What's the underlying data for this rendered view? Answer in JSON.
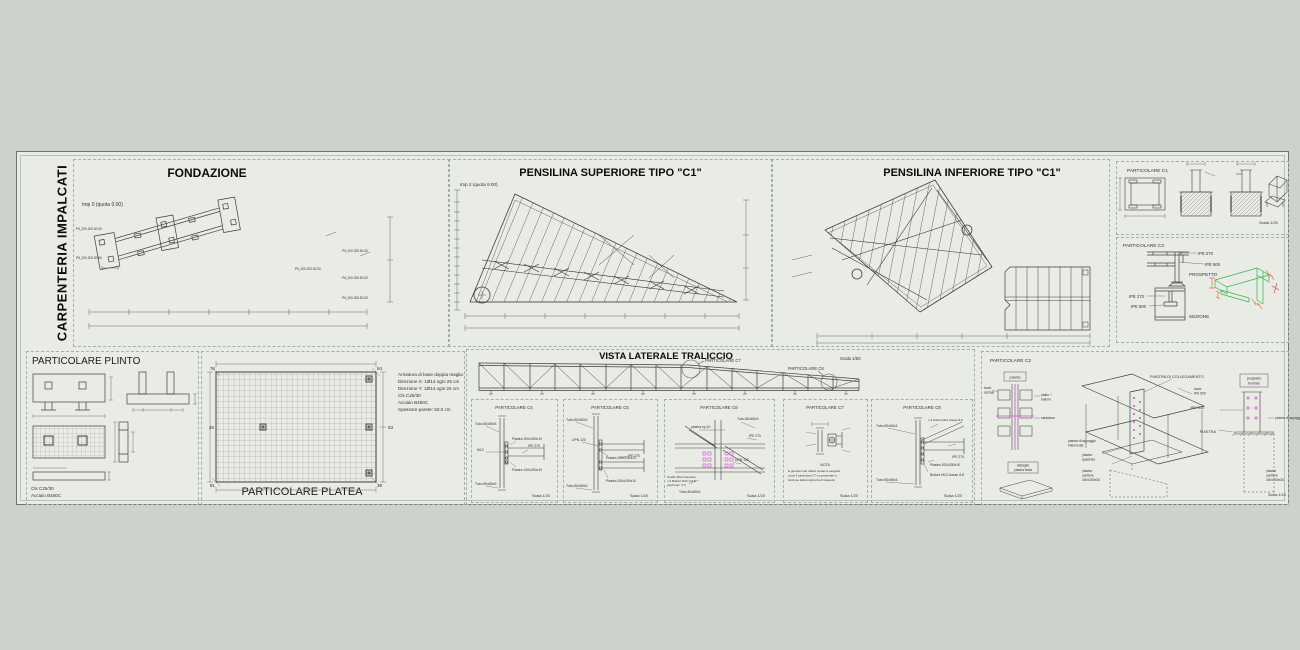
{
  "sheet": {
    "side_label": "CARPENTERIA IMPALCATI"
  },
  "fond": {
    "title": "FONDAZIONE",
    "level": "Imp 0 (quota 0.00)",
    "tag": "Plt_200.200.50.00"
  },
  "sup": {
    "title": "PENSILINA SUPERIORE TIPO \"C1\"",
    "level": "Imp 2 (quota 9.00)"
  },
  "inf": {
    "title": "PENSILINA INFERIORE TIPO \"C1\""
  },
  "c1": {
    "title": "PARTICOLARE C1",
    "scale": "Scala 1/20"
  },
  "c3": {
    "title": "PARTICOLARE C3",
    "ipe270": "IPE 270",
    "ipe500": "IPE 500",
    "prospetto": "PROSPETTO",
    "sezione": "SEZIONE"
  },
  "plinto": {
    "title": "PARTICOLARE PLINTO",
    "cls": "Cls C25/30",
    "acciaio": "Acciaio B450C"
  },
  "platea": {
    "title": "PARTICOLARE PLATEA",
    "corners": {
      "tl": "76",
      "tr": "64",
      "ml": "45",
      "mr": "53",
      "bl": "81",
      "br": "19"
    },
    "notes": [
      "Armatura di base doppia maglia",
      "Direzione X: 1Ø14 ogni 25 cm",
      "Direzione Y: 1Ø14 ogni 25 cm",
      "Cls C25/30",
      "Acciaio B450C",
      "Spessore parete: 50.0 cm"
    ]
  },
  "vista": {
    "title": "VISTA LATERALE TRALICCIO",
    "scale": "Scala 1/50",
    "c7": "PARTICOLARE C7",
    "c8": "PARTICOLARE C8"
  },
  "c4": {
    "title": "PARTICOLARE C4",
    "scale": "Scala 1/20",
    "l1": "Tubo 80x80x3",
    "l2": "M12",
    "l3": "Piastra 200x200x10",
    "l4": "IPE 270",
    "l5": "Piastra 120x200x10",
    "l6": "Tubo 80x80x3"
  },
  "c5": {
    "title": "PARTICOLARE C5",
    "scale": "Scala 1/20",
    "l1": "Tubo 80x80x3",
    "l2": "UPN 120",
    "l3": "Piastra 200x200x10",
    "l4": "IPE 270",
    "l5": "Piastra 200x200x10",
    "l6": "Tubo 80x80x3"
  },
  "c6": {
    "title": "PARTICOLARE C6",
    "scale": "Scala 1/20",
    "l1": "piastra sp.10",
    "l2": "Tubo 80x80x3",
    "l3": "IPE 270",
    "l4": "UPN 120",
    "n1": "Graffe 30x3 interasse",
    "n2": "n.4 Bulloni M12 cl.8.8",
    "n3": "(vedi part. C7)",
    "l6": "Tubo 80x80x3"
  },
  "c7": {
    "title": "PARTICOLARE C7",
    "scale": "Scala 1/20",
    "nota": "NOTA",
    "n1": "le giunzioni dei tralicci verranno eseguite",
    "n2": "come il particolare C7 e posizionate in",
    "n3": "funzione della lunghezza di trasporto"
  },
  "c8": {
    "title": "PARTICOLARE C8",
    "scale": "Scala 1/20",
    "l1": "Tubo 80x80x3",
    "l2": "n.4 bulloni M12 classe 8.8",
    "l3": "IPE 270",
    "l4": "Piastra 200x200x10",
    "l5": "Bulloni M12 classe 8.8",
    "l6": "Tubo 80x80x3"
  },
  "c2": {
    "title": "PARTICOLARE C2",
    "scale": "Scala 1/10",
    "pianta": "pianta",
    "ta1": "trave",
    "ta2": "acciaio",
    "pb1": "piatto +",
    "pb2": "bulloni",
    "sald": "saldatura",
    "det1": "dettaglio",
    "det2": "piastra testa",
    "coll": "PIASTRA DI COLLEGAMENTO",
    "tr1": "trave",
    "tr2": "IPE 500",
    "app1": "piastra di appoggio",
    "app2": "intermedia",
    "q1": "piastra",
    "q2": "quadrata",
    "cant1": "piastra",
    "cant2": "cantiere",
    "cant3": "300x300x30",
    "pf1": "prospetto",
    "pf2": "frontale",
    "ipe500": "IPE 500",
    "piastra": "PIASTRA",
    "appoggio": "piastra di appoggio"
  },
  "colors": {
    "magenta": "#cf4fcf",
    "green": "#2eb84f",
    "orange": "#f08a64",
    "red": "#d03a2a"
  }
}
